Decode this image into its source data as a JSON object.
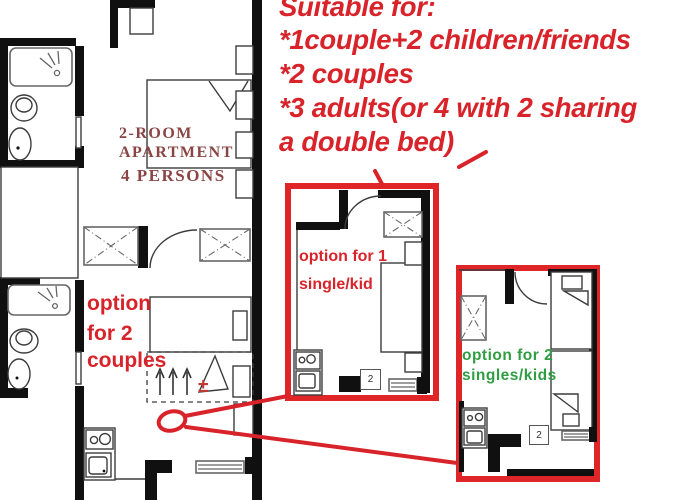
{
  "colors": {
    "accent_red": "#d9232a",
    "inset_border_red": "#e02528",
    "plan_title_maroon": "#8a4545",
    "green_label": "#2f9e43"
  },
  "annotation": {
    "title": "Suitable for:",
    "lines": [
      "*1couple+2 children/friends",
      "*2 couples",
      "*3 adults(or 4 with 2 sharing",
      "a double bed)"
    ]
  },
  "main_plan": {
    "title_line1": "2-ROOM",
    "title_line2": "APARTMENT",
    "subtitle": "4 PERSONS",
    "option_label": {
      "line1": "option",
      "line2": "for 2",
      "line3": "couples"
    },
    "plus_minus": "±"
  },
  "inset_single": {
    "label_line1": "option for 1",
    "label_line2": "single/kid",
    "badge": "2"
  },
  "inset_two_singles": {
    "label_line1": "option for 2",
    "label_line2": "singles/kids",
    "badge": "2"
  }
}
